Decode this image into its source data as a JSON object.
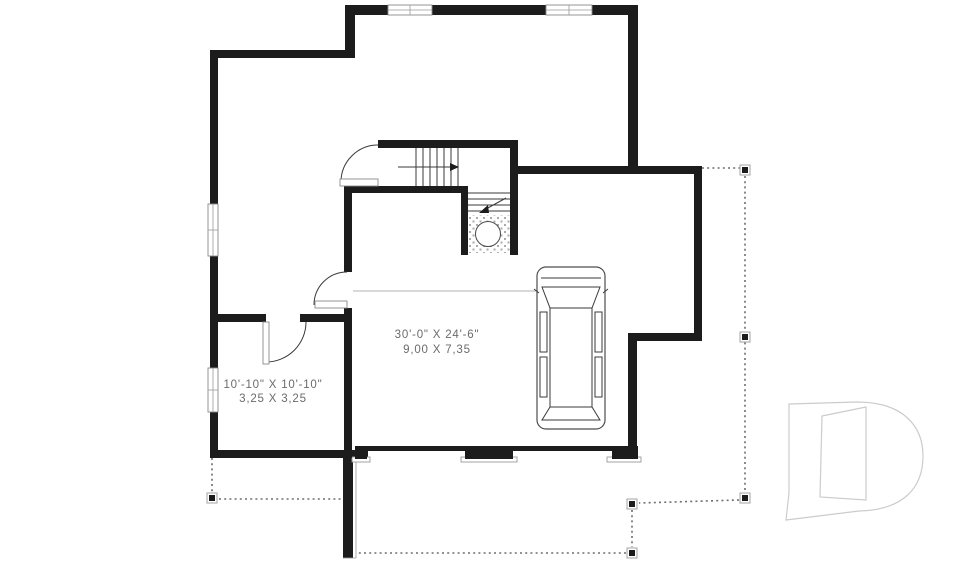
{
  "page": {
    "type": "floor-plan-drawing",
    "background": "#ffffff"
  },
  "plan": {
    "rooms": [
      {
        "id": "garage",
        "dim_imperial": "30'-0\" X 24'-6\"",
        "dim_metric": "9,00 X 7,35"
      },
      {
        "id": "storage-room",
        "dim_imperial": "10'-10\" X 10'-10\"",
        "dim_metric": "3,25 X 3,25"
      }
    ],
    "features": [
      "l-shaped-staircase",
      "water-heater-circle",
      "parked-van-top-view",
      "two-garage-door-openings",
      "wrap-around-porch-dashed-outline",
      "six-porch-posts",
      "four-windows",
      "three-interior-doors"
    ],
    "colors": {
      "wall": "#1c1c1c",
      "thin": "#3a3a3a",
      "dashed": "#6e6e6e",
      "label": "#6b6b6b",
      "logo": "#cccccc",
      "bg": "#ffffff"
    }
  },
  "branding": {
    "logo_name": "drummond-d-watermark"
  }
}
